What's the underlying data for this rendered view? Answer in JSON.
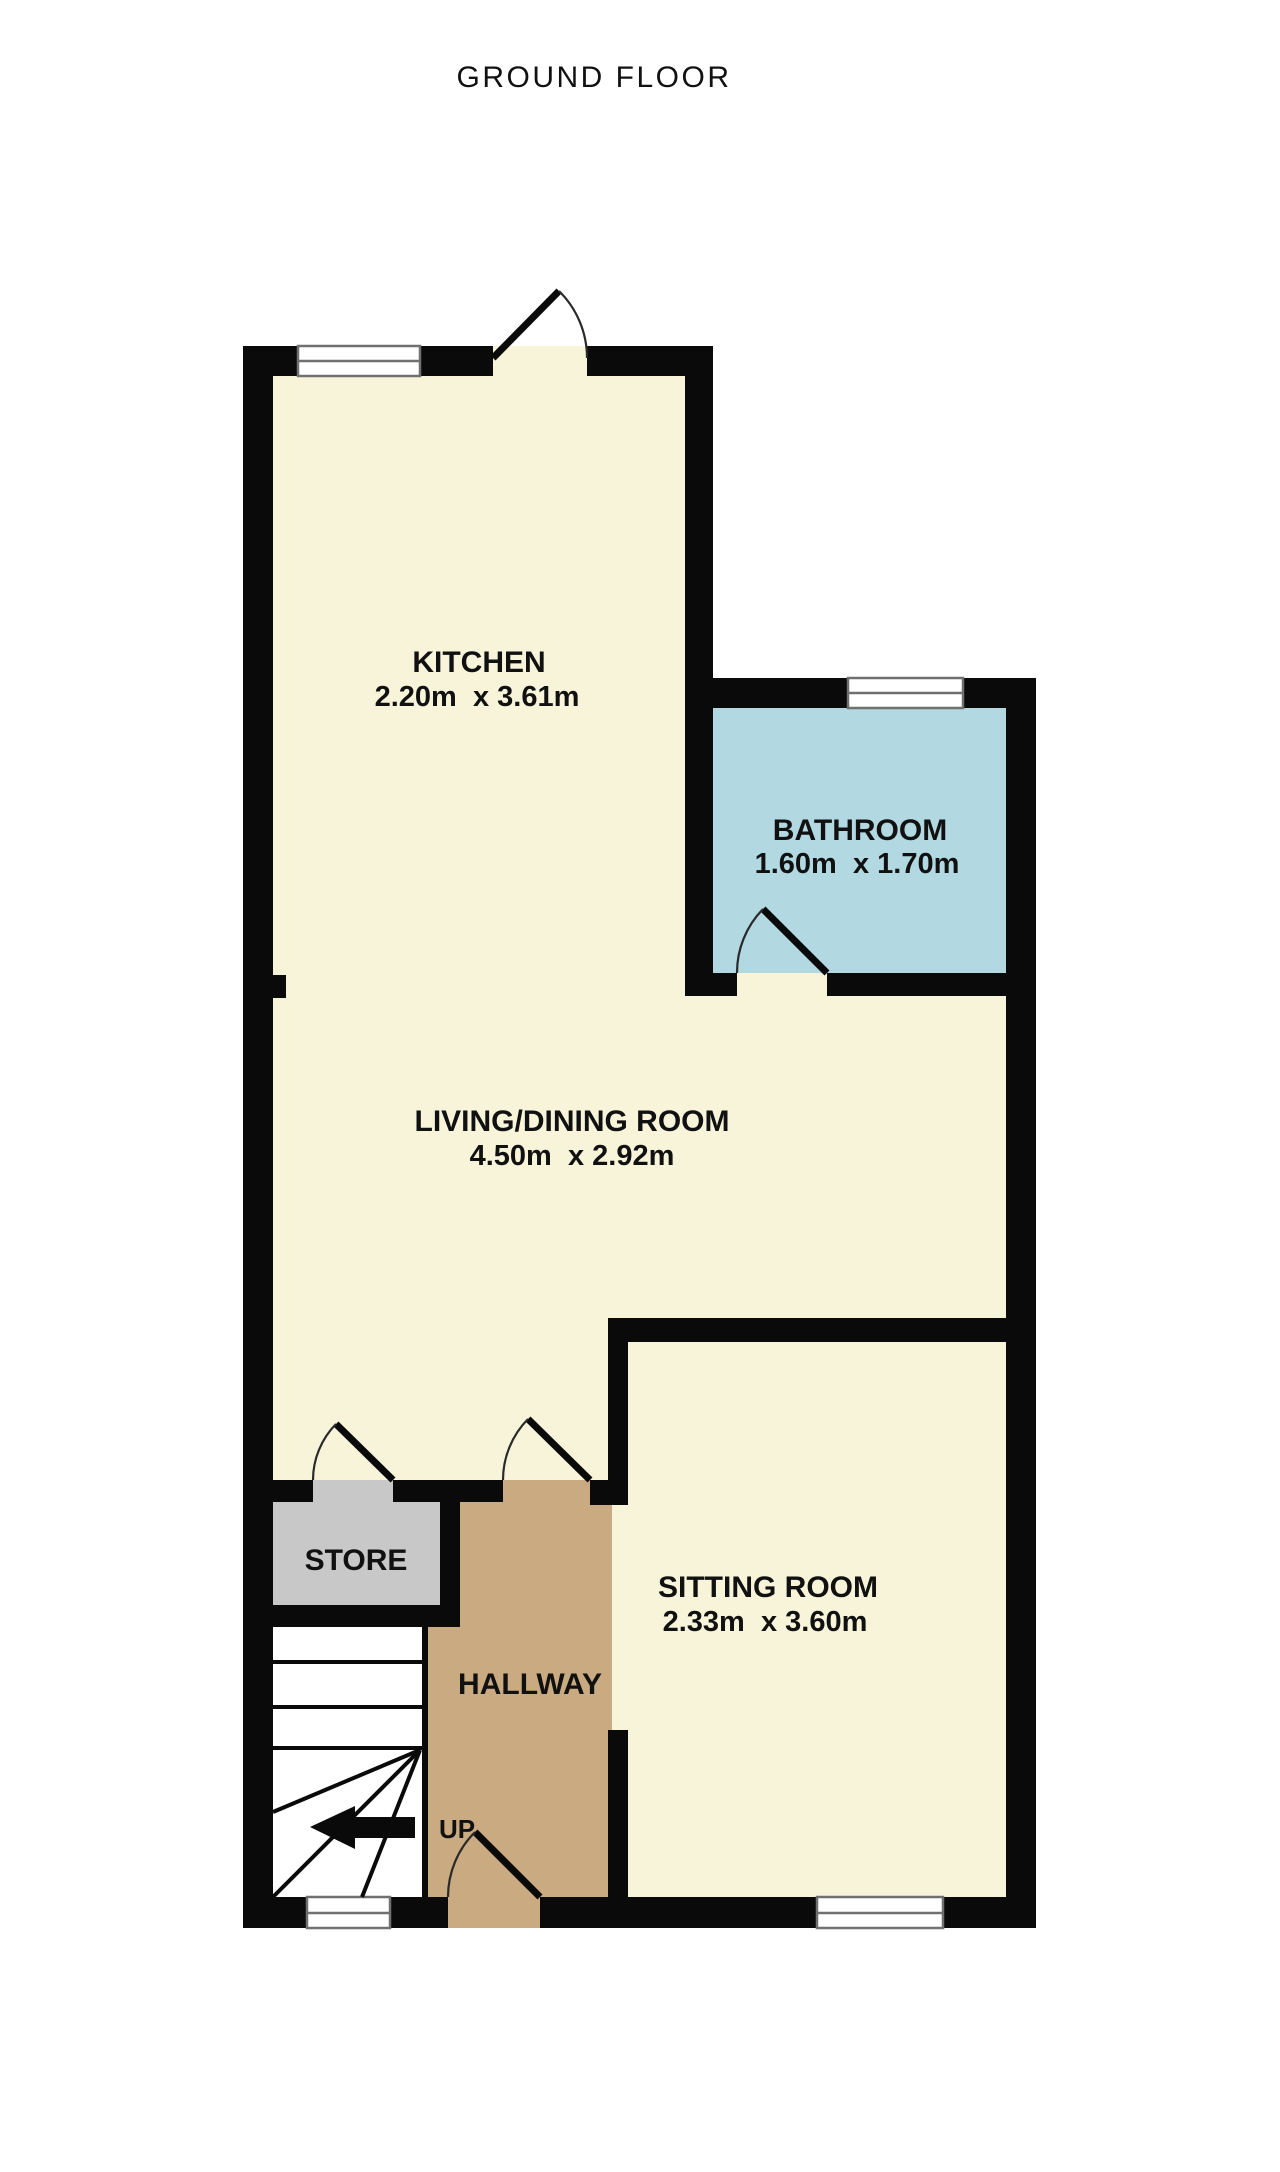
{
  "page": {
    "title": "GROUND FLOOR"
  },
  "colors": {
    "wall": "#0a0a0a",
    "floor_cream": "#f8f4da",
    "bathroom_blue": "#b2d8e1",
    "hallway_tan": "#c9aa81",
    "store_grey": "#c8c8c8",
    "stairs_white": "#ffffff",
    "window_white": "#ffffff",
    "title_text": "#7b7b7b",
    "label_text": "#111111",
    "arrow_black": "#0a0a0a"
  },
  "rooms": {
    "kitchen": {
      "name": "KITCHEN",
      "dims": "2.20m  x 3.61m"
    },
    "bathroom": {
      "name": "BATHROOM",
      "dims": "1.60m  x 1.70m"
    },
    "living_dining": {
      "name": "LIVING/DINING ROOM",
      "dims": "4.50m  x 2.92m"
    },
    "sitting": {
      "name": "SITTING ROOM",
      "dims": "2.33m  x 3.60m"
    },
    "store": {
      "name": "STORE"
    },
    "hallway": {
      "name": "HALLWAY"
    }
  },
  "stairs": {
    "direction_label": "UP"
  }
}
